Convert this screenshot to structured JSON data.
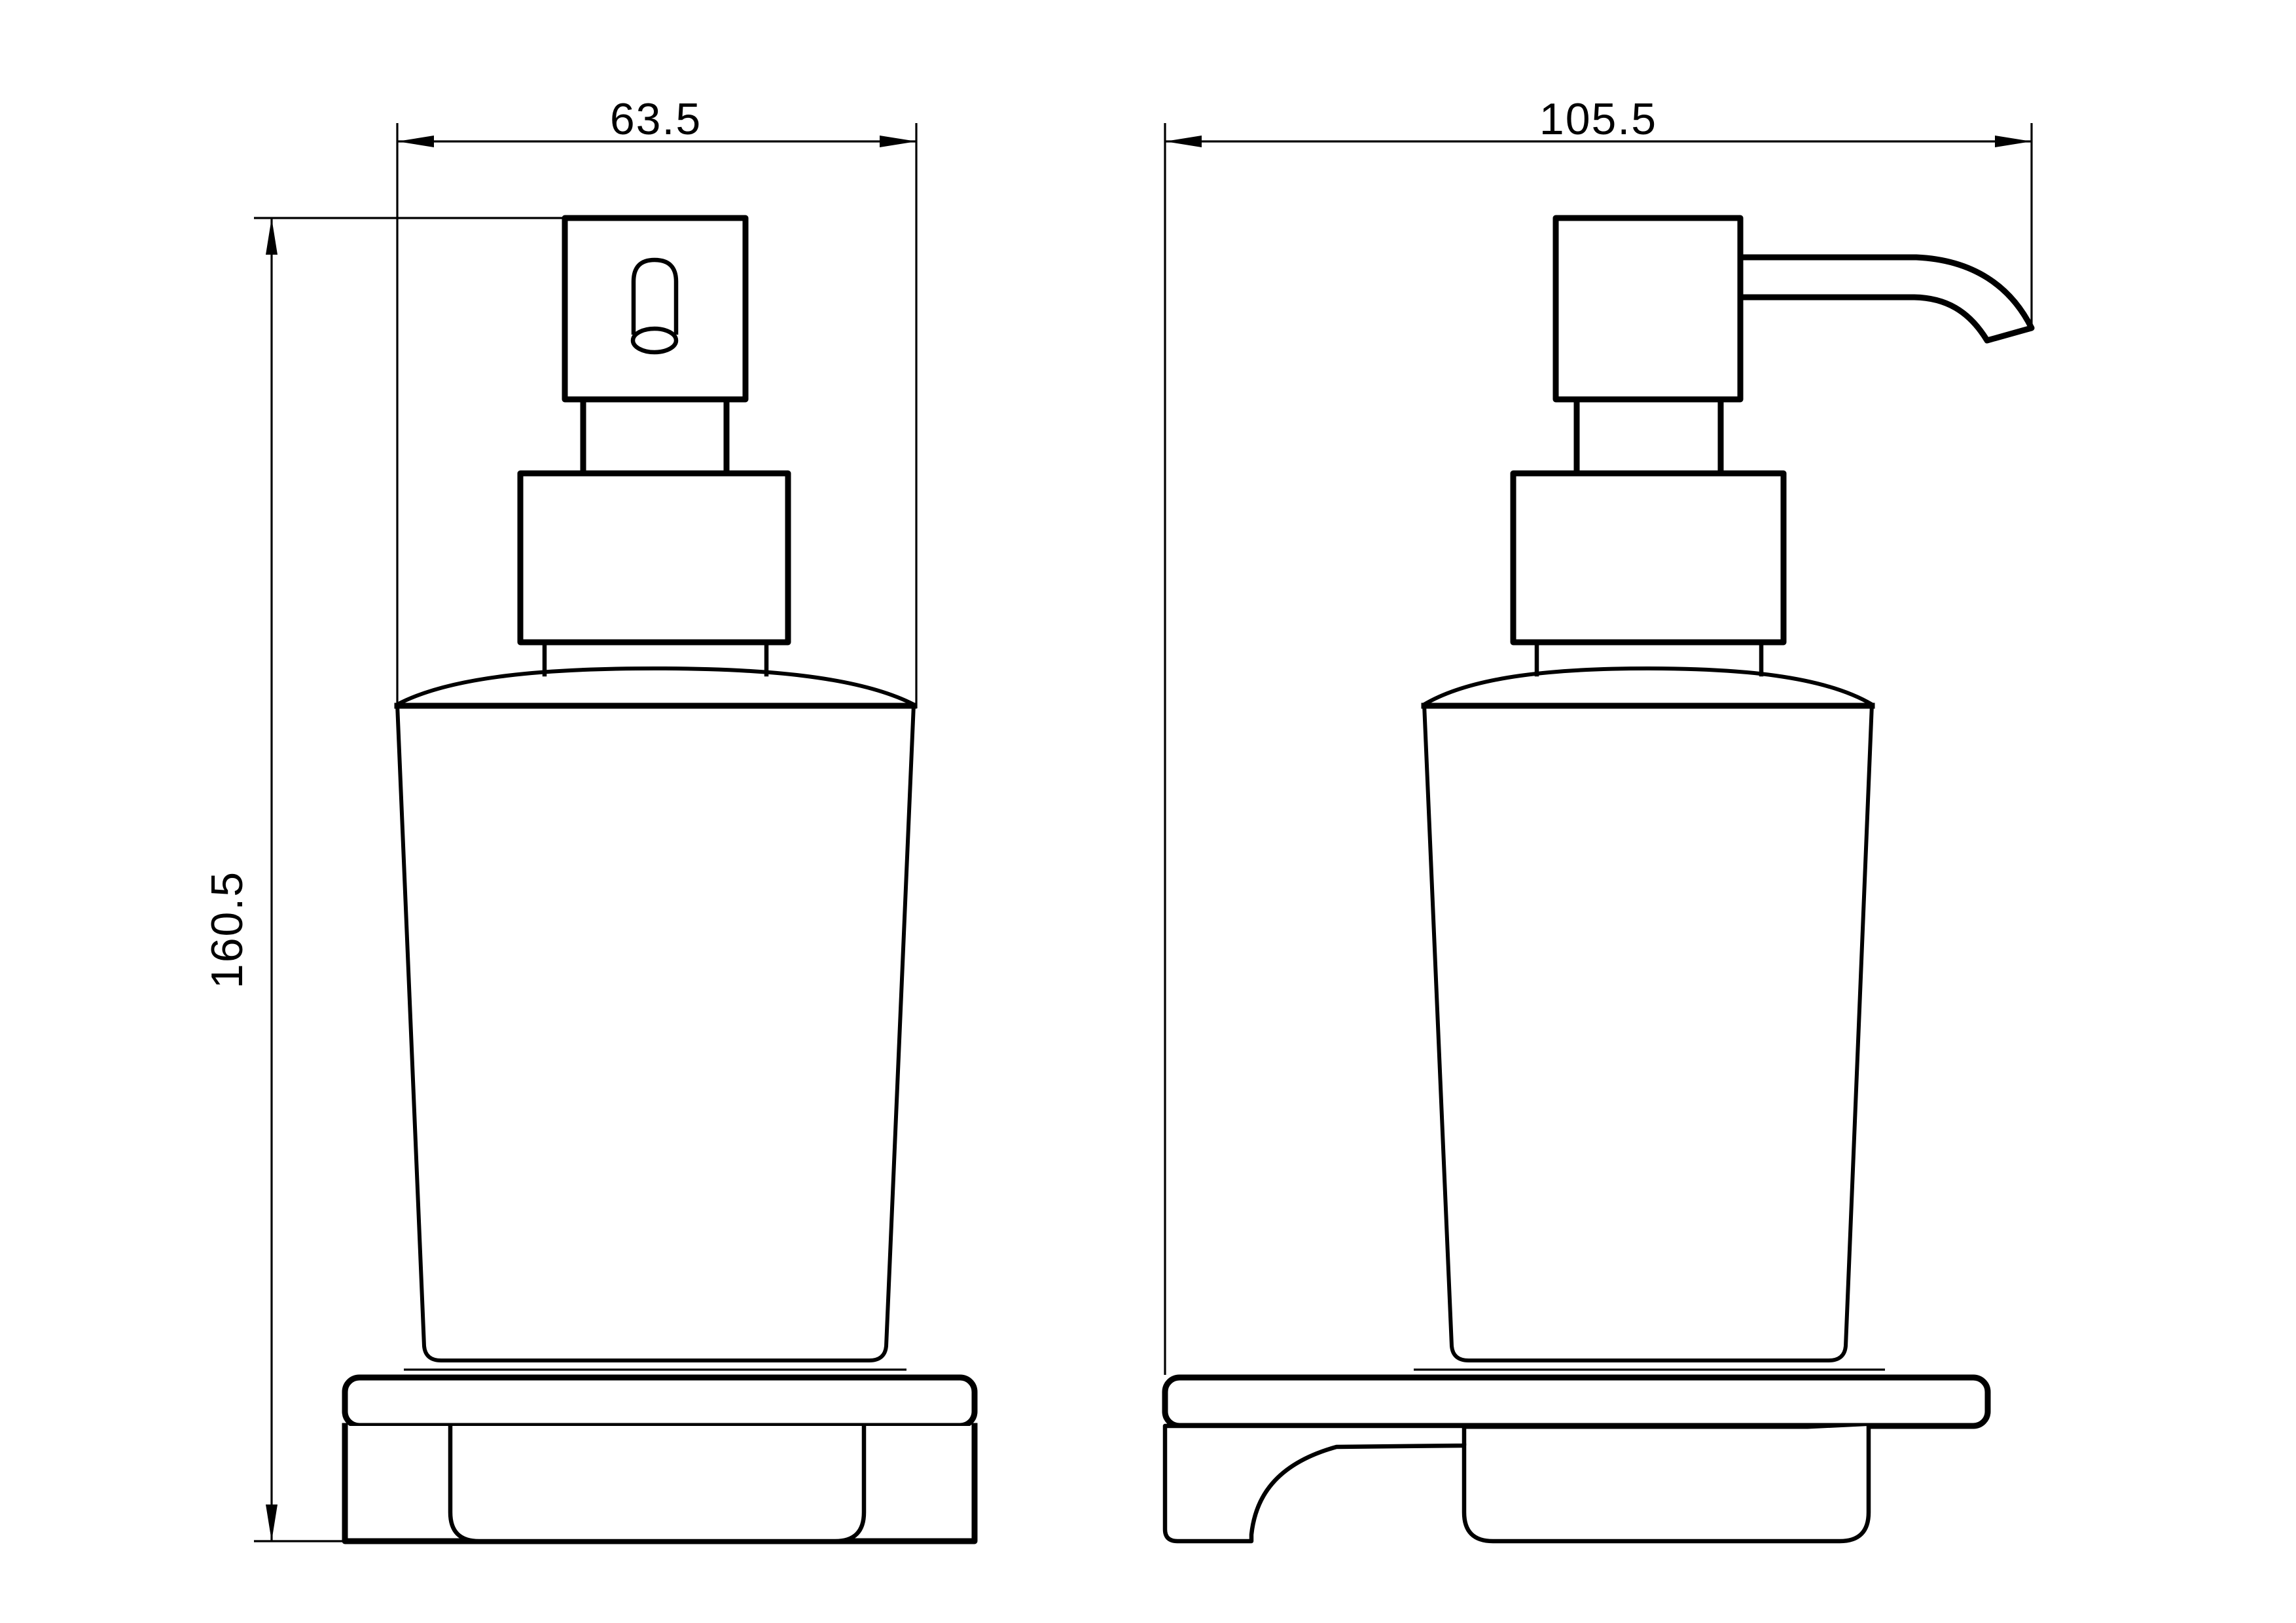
{
  "drawing": {
    "kind": "technical-drawing",
    "subject": "wall-mounted glass soap dispenser with holder, two orthographic views",
    "background_color": "#ffffff",
    "line_color": "#000000",
    "views": {
      "front": {
        "width_dimension": {
          "value": "63.5"
        },
        "height_dimension": {
          "value": "160.5"
        }
      },
      "side": {
        "depth_dimension": {
          "value": "105.5"
        }
      }
    }
  }
}
